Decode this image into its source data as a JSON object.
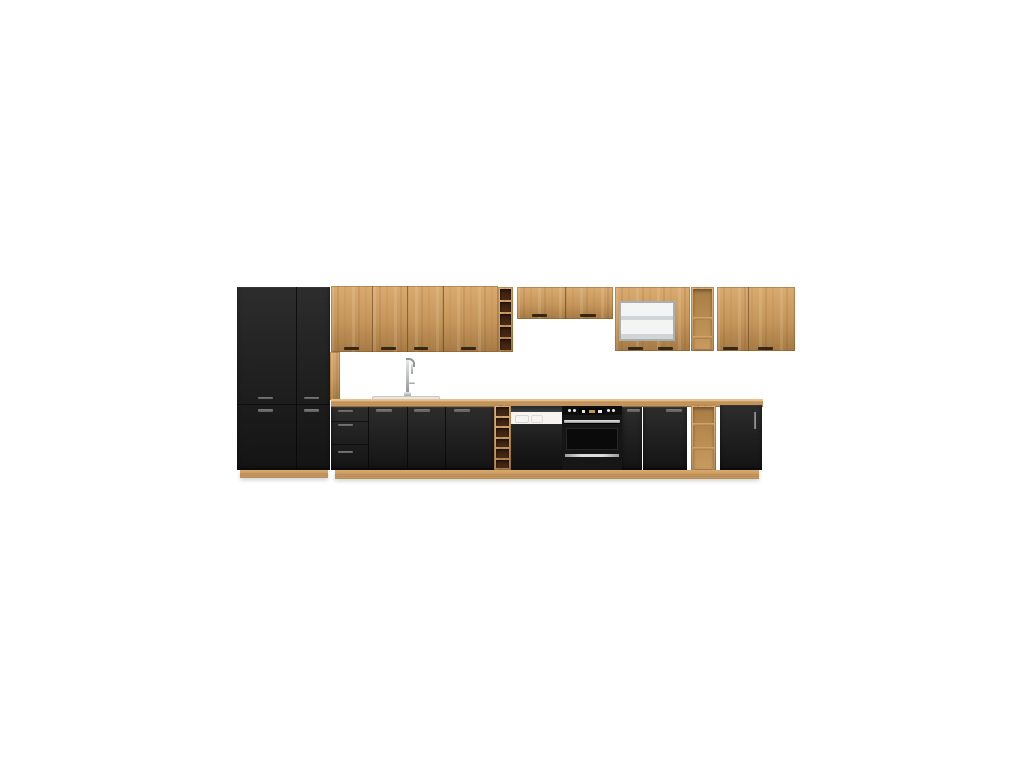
{
  "scene": {
    "kind": "product-photo",
    "subject": "modular-kitchen-set",
    "finish_front": "matt-black",
    "finish_carcass": "artisan-oak",
    "background_color": "#ffffff"
  },
  "palette": {
    "bg": "#ffffff",
    "oak": "#c5965c",
    "oak_light": "#d9ab70",
    "oak_dark": "#a57a44",
    "plinth_top": "#c2914f",
    "plinth_bottom": "#9f7440",
    "front_black": "#212121",
    "front_black_light": "#2d2d2d",
    "front_black_dark": "#141414",
    "handle_gray": "#5f5f5f",
    "handle_wood": "#342718",
    "rack_cell": "#4a2c17",
    "rack_cell_dark": "#331c0c",
    "niche": "#c79a5f",
    "niche_dark": "#aa7d45",
    "steel": "#c3c6c7",
    "steel_dark": "#8f9496",
    "dw_white": "#f5f4f1",
    "dw_strip": "#3c4144",
    "oven_panel": "#0e0e0e",
    "oven_door": "#161616",
    "oven_window": "#0a0a0a",
    "oven_glare": "#dcdcda",
    "display_amber": "#c79a3a",
    "glass_frame": "#a9aeb0",
    "glass_fill": "#f3f4f4",
    "glass_shelf": "#d0d5d7",
    "sink": "#e7e6e1",
    "sink_rim": "#c9c8c2"
  },
  "counts": {
    "upper_rack_cells": 5,
    "base_rack_cells": 6
  },
  "units": [
    {
      "name": "tall-larder-cabinet",
      "finish": "matt-black"
    },
    {
      "name": "wall-cabinet-run-left",
      "finish": "artisan-oak",
      "doors": 4
    },
    {
      "name": "upper-wine-rack",
      "openings": 5
    },
    {
      "name": "wall-cabinet-short",
      "finish": "artisan-oak",
      "doors": 2
    },
    {
      "name": "wall-glass-display-cabinet",
      "finish": "artisan-oak-glass"
    },
    {
      "name": "upper-open-shelf-unit",
      "openings": 3
    },
    {
      "name": "wall-cabinet-run-right",
      "finish": "artisan-oak",
      "doors": 2
    },
    {
      "name": "base-drawer-unit",
      "drawers": 3
    },
    {
      "name": "base-sink-cabinet",
      "doors": 3
    },
    {
      "name": "base-wine-rack",
      "openings": 6
    },
    {
      "name": "dishwasher",
      "finish": "semi-integrated-white-black"
    },
    {
      "name": "built-in-oven",
      "finish": "black-steel"
    },
    {
      "name": "base-cabinets-right",
      "doors": 2
    },
    {
      "name": "base-open-shelf-unit",
      "openings": 3
    },
    {
      "name": "base-end-cabinet",
      "doors": 1
    },
    {
      "name": "worktop",
      "finish": "artisan-oak"
    },
    {
      "name": "sink-with-mixer-tap",
      "finish": "white-chrome"
    }
  ]
}
